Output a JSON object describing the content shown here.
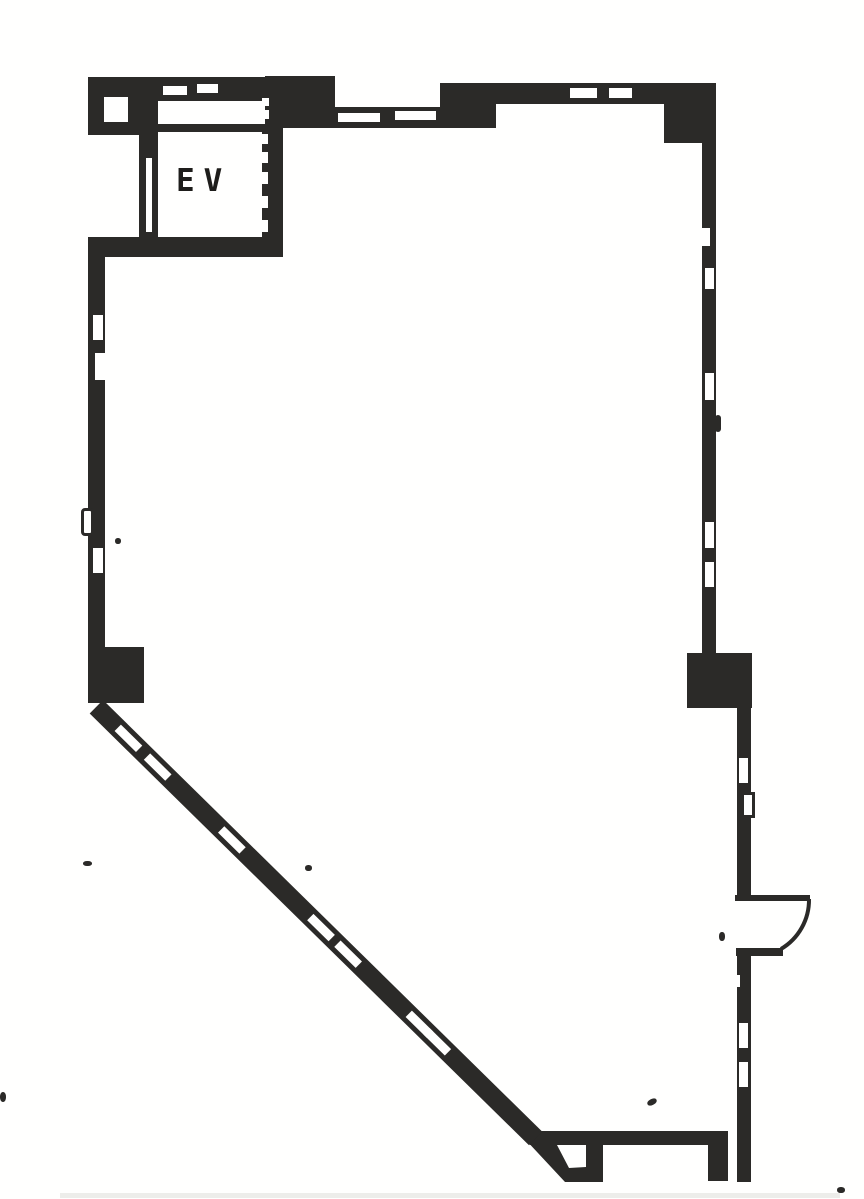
{
  "floorplan": {
    "elevator_label": "EV",
    "colors": {
      "wall": "#2e2d2b",
      "paper": "#fbfbf9",
      "smudge": "#e9e9e6",
      "label": "#22211f"
    }
  }
}
